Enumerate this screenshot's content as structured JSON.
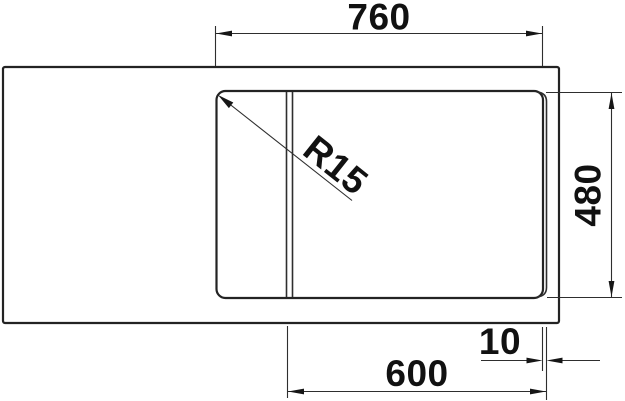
{
  "drawing": {
    "description": "sink-technical-drawing-top-view",
    "dimensions": {
      "top_width": "760",
      "right_depth": "480",
      "bottom_width": "600",
      "right_gap": "10",
      "corner_radius": "R15"
    },
    "colors": {
      "line": "#232323",
      "text": "#111111",
      "background": "#ffffff"
    }
  }
}
